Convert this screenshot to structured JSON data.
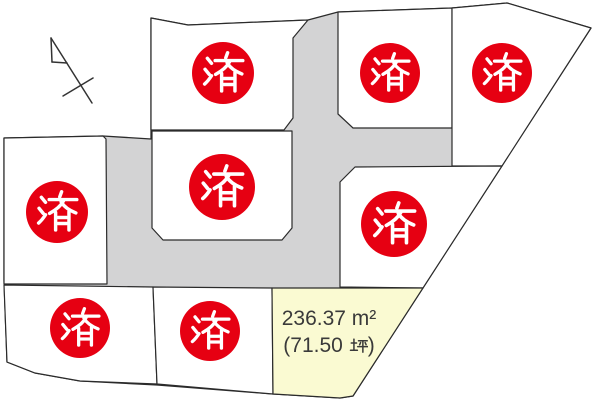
{
  "map": {
    "kind": "land-subdivision-lot-map",
    "sold_stamp": {
      "label": "済"
    },
    "available_lot": {
      "area_sqm": "236.37 m²",
      "area_tsubo_open": "(71.50",
      "area_tsubo_unit": "坪",
      "area_tsubo_close": ")"
    },
    "colors": {
      "road": "#d3d3d4",
      "lot_fill": "#ffffff",
      "available_fill": "#fafad2",
      "stamp_red": "#e60012",
      "line": "#2b2b2b"
    }
  }
}
